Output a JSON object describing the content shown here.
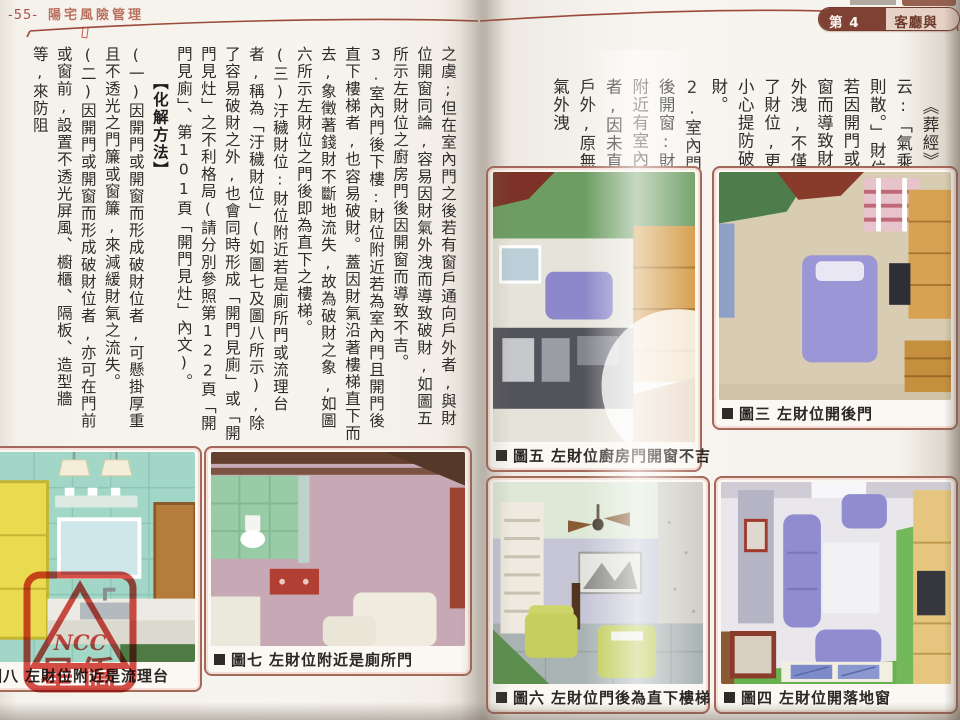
{
  "left_page": {
    "header": {
      "page_number": "-55-",
      "book_title": "陽宅風險管理"
    },
    "body": [
      {
        "style": "body",
        "text": "之虞;但在室內門之後若有窗戶通向戶外者,與財位開窗同論,容易因財氣外洩而導致破財,如圖五所示左財位之廚房門後因開窗而導致不吉。"
      },
      {
        "style": "body",
        "text": "3.室內門後下樓:財位附近若為室內門且開門後直下樓梯者,也容易破財。蓋因財氣沿著樓梯直下而去,象徵著錢財不斷地流失,故為破財之象,如圖六所示左財位之門後即為直下之樓梯。"
      },
      {
        "style": "body",
        "text": "(三)汙穢財位:財位附近若是廁所門或流理台者,稱為「汙穢財位」(如圖七及圖八所示),除了容易破財之外,也會同時形成「開門見廁」或「開門見灶」之不利格局(請分別參照第122頁「開門見廁」、第101頁「開門見灶」內文)。"
      },
      {
        "style": "heading",
        "text": "【化解方法】"
      },
      {
        "style": "body",
        "text": "(一)因開門或開窗而形成破財位者,可懸掛厚重且不透光之門簾或窗簾,來減緩財氣之流失。"
      },
      {
        "style": "body",
        "text": "(二)因開門或開窗而形成破財位者,亦可在門前或窗前,設置不透光屏風、櫥櫃、隔板、造型牆等,來防阻"
      }
    ],
    "figures": {
      "fig8": {
        "label": "圖八",
        "title": "左財位附近是流理台"
      },
      "fig7": {
        "label": "圖七",
        "title": "左財位附近是廁所門"
      }
    }
  },
  "right_page": {
    "header": {
      "unit_label": "第 4 單元",
      "unit_title": "客廳與書房"
    },
    "body": [
      {
        "text": "《葬經》有云:「氣乘風則散。」財位若因開門或開窗而導致財氣外洩,不僅沒了財位,更要小心提防破財。"
      },
      {
        "text": "2.室內門後開窗:財位附近有室內門者,因未直通戶外,原無財氣外洩"
      }
    ],
    "figures": {
      "fig3": {
        "label": "圖三",
        "title": "左財位開後門"
      },
      "fig5": {
        "label": "圖五",
        "title": "左財位廚房門開窗不吉"
      },
      "fig6": {
        "label": "圖六",
        "title": "左財位門後為直下樓梯"
      },
      "fig4": {
        "label": "圖四",
        "title": "左財位開落地窗"
      }
    }
  },
  "watermark": {
    "line1": "NCC",
    "line2": "星僑"
  },
  "colors": {
    "accent_brown": "#8a4a38",
    "badge_dark": "#7e4134",
    "badge_light": "#e7d0c5",
    "stamp_red": "#d03028",
    "figure_frame": "#a4685a"
  }
}
